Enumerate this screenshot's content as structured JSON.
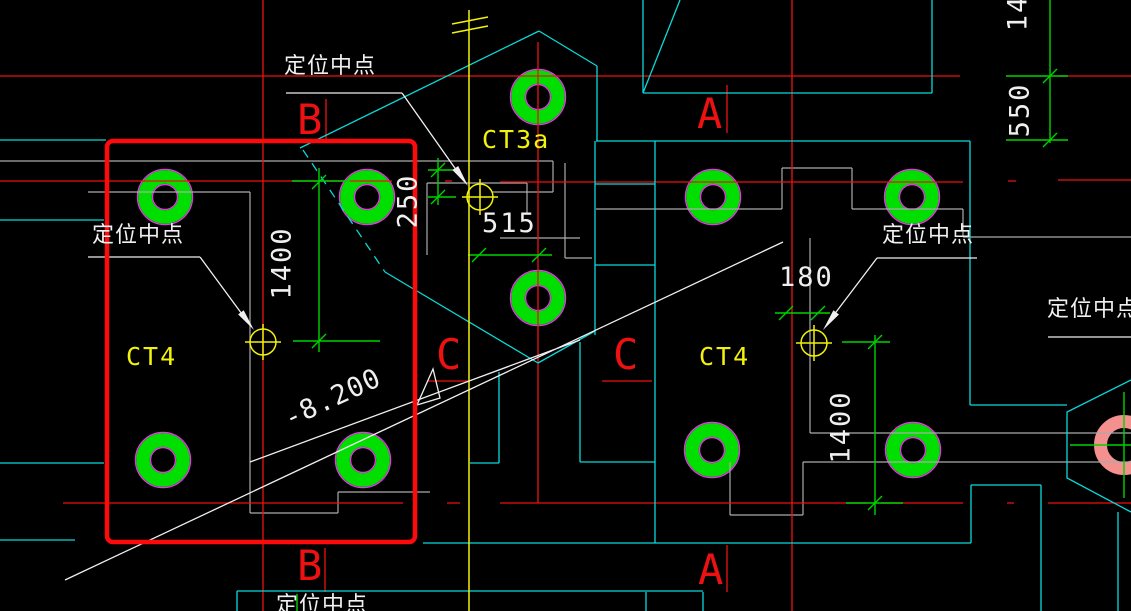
{
  "viewport": {
    "width": 1131,
    "height": 611,
    "background": "#000000",
    "description": "CAD drawing viewport: pile-cap plan with red selection window"
  },
  "colors": {
    "grid_red": "#ed1111",
    "selection_red": "#ff0a0a",
    "construction_cyan": "#0bd9d9",
    "dimension_green": "#00d400",
    "pile_green": "#00df00",
    "pile_outline_magenta": "#e23ce2",
    "pile_pink": "#f4908e",
    "annotation_white": "#f0f0f0",
    "label_yellow": "#f2f20c",
    "outline_gray": "#ababab"
  },
  "grid_labels": {
    "top_b": "B",
    "top_a": "A",
    "mid_c_left": "C",
    "mid_c_right": "C",
    "bottom_b": "B",
    "bottom_a": "A"
  },
  "component_labels": {
    "ct4_left": "CT4",
    "ct3a": "CT3a",
    "ct4_right": "CT4"
  },
  "anchor_notes": {
    "top": "定位中点",
    "left": "定位中点",
    "right": "定位中点",
    "far_right": "定位中点",
    "bottom_partial": "定位中点"
  },
  "dimensions": {
    "d250": "250",
    "d515": "515",
    "d1400_left": "1400",
    "d180": "180",
    "d1400_right": "1400",
    "d550": "550",
    "d14_top": "14"
  },
  "elevation_marker": {
    "value": "-8.200"
  }
}
